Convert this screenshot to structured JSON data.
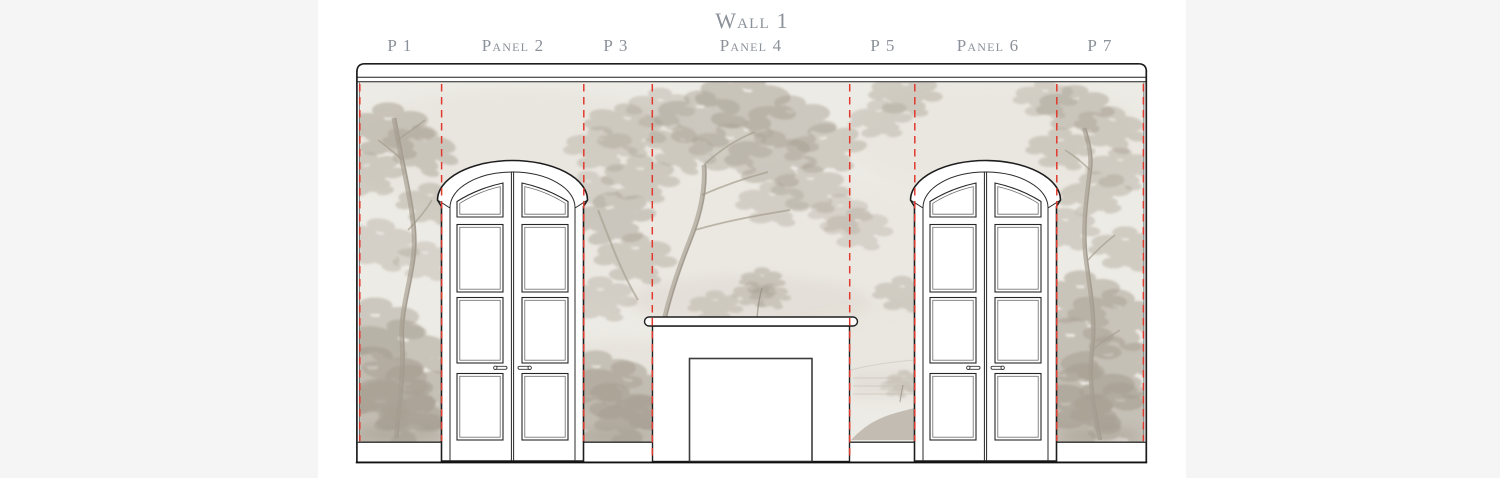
{
  "header": {
    "title": "Wall 1"
  },
  "panels": [
    {
      "label": "P 1"
    },
    {
      "label": "Panel 2"
    },
    {
      "label": "P 3"
    },
    {
      "label": "Panel 4"
    },
    {
      "label": "P 5"
    },
    {
      "label": "Panel 6"
    },
    {
      "label": "P 7"
    }
  ],
  "colors": {
    "background": "#f5f5f6",
    "artboard": "#ffffff",
    "seam_red": "#e03a2e",
    "label_gray": "#8b9199",
    "mural_base": "#edebe5",
    "outline": "#1d1d1d"
  }
}
